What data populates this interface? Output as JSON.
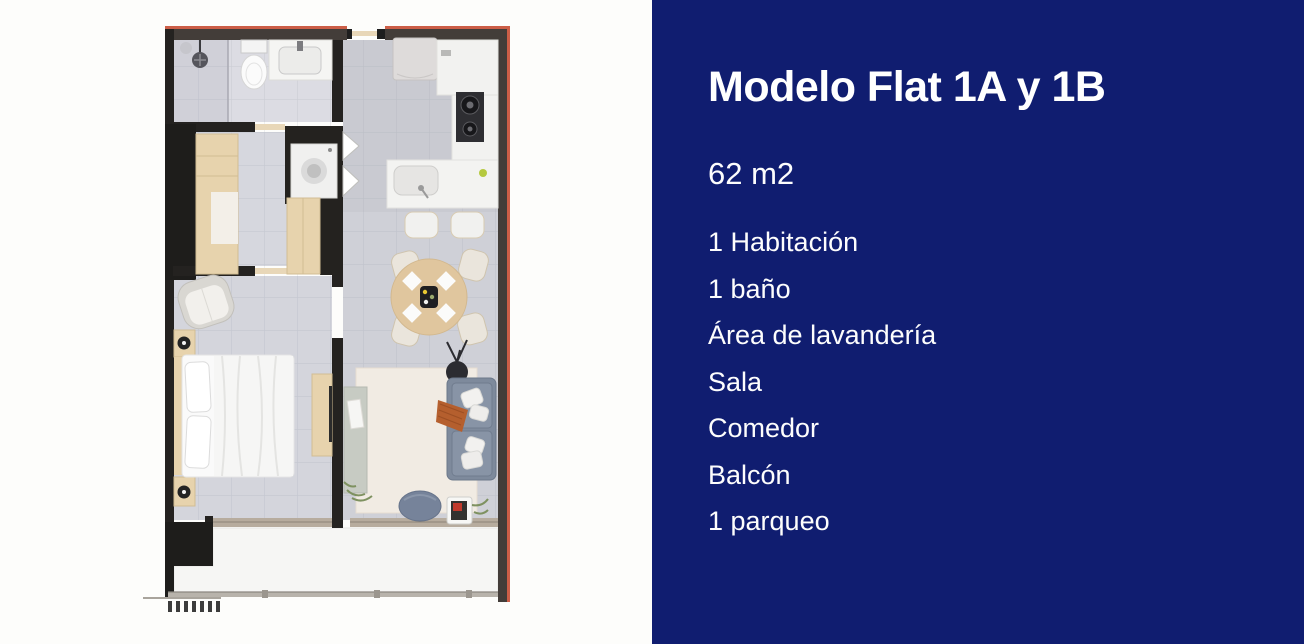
{
  "panel": {
    "title": "Modelo Flat 1A y 1B",
    "area": "62 m2",
    "features": [
      "1 Habitación",
      "1 baño",
      "Área de lavandería",
      "Sala",
      "Comedor",
      "Balcón",
      "1 parqueo"
    ]
  },
  "colors": {
    "panel_bg": "#101d70",
    "panel_text": "#ffffff",
    "canvas_bg": "#fdfdfb",
    "wall_dark": "#262320",
    "wall_accent_red": "#cc5e47",
    "floor_tile": "#cfd0d7",
    "bathroom_floor": "#dcdce3",
    "wood": "#e7d3ad",
    "counter_white": "#f2f2f0",
    "sofa_blue": "#7e8a9c",
    "rug_cream": "#f1ebe3",
    "throw_orange": "#b55f2e",
    "balcony_floor": "#f6f6f4"
  }
}
